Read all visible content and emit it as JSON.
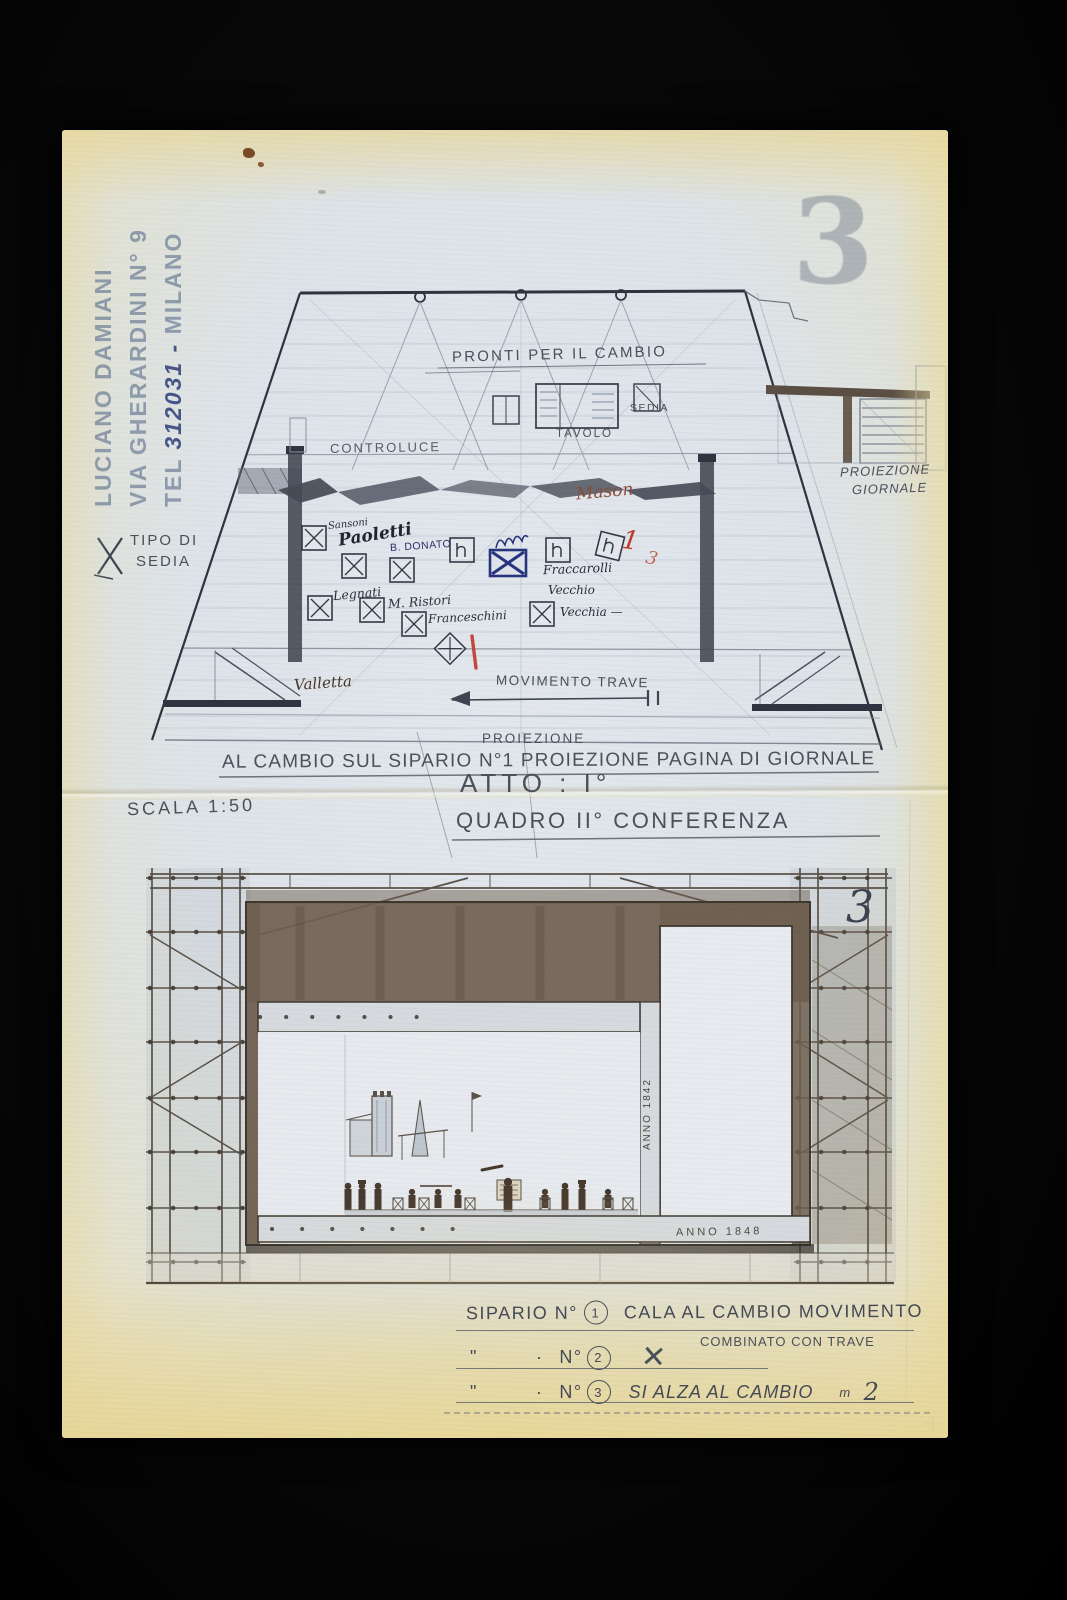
{
  "colors": {
    "red_ink": "#c0392b",
    "blue_ink": "#27357e",
    "sepia": "#6f6050",
    "stamp_blue": "#6c7a94",
    "paper_yellow": "#e9dfb6"
  },
  "stamp": {
    "line1": "LUCIANO DAMIANI",
    "line2": "VIA GHERARDINI N° 9",
    "tel_prefix": "TEL ",
    "tel_number": "312031 -",
    "tel_city": " MILANO"
  },
  "sheet": {
    "number_stamp": "3",
    "number_note": "3"
  },
  "plan": {
    "pronti": "PRONTI PER IL CAMBIO",
    "tavolo": "TAVOLO",
    "sedia": "SEDIA",
    "controluce": "CONTROLUCE",
    "tipo_di_sedia_line1": "TIPO DI",
    "tipo_di_sedia_line2": "SEDIA",
    "mason": "Mason",
    "valletta": "Valletta",
    "movimento_trave": "MOVIMENTO TRAVE",
    "proiezione": "PROIEZIONE",
    "proiezione_giornale_line1": "PROIEZIONE",
    "proiezione_giornale_line2": "GIORNALE",
    "names": {
      "sansoni": "Sansoni",
      "paoletti": "Paoletti",
      "b_donato": "B. DONATO",
      "legnati": "Legnati",
      "ristori": "M. Ristori",
      "franceschini": "Franceschini",
      "fraccarolli": "Fraccarolli",
      "vecchio": "Vecchio",
      "vecchia": "Vecchia —"
    },
    "red_marks": {
      "one": "1",
      "three": "3"
    }
  },
  "captions": {
    "cambio": "AL CAMBIO SUL SIPARIO N°1 PROIEZIONE PAGINA DI GIORNALE",
    "atto": "ATTO : I°",
    "scala": "SCALA 1:50",
    "quadro": "QUADRO II° CONFERENZA"
  },
  "elevation": {
    "anno_side": "ANNO 1842",
    "anno_beam": "ANNO 1848"
  },
  "legend": {
    "row1_label": "SIPARIO N°",
    "row1_num": "1",
    "row1_text": "CALA AL CAMBIO MOVIMENTO",
    "row1_sub": "COMBINATO CON TRAVE",
    "row2_ditto": "\"",
    "row2_dot": "·",
    "row2_label": "N°",
    "row2_num": "2",
    "row2_mark": "✕",
    "row3_ditto": "\"",
    "row3_dot": "·",
    "row3_label": "N°",
    "row3_num": "3",
    "row3_text": "SI ALZA AL CAMBIO",
    "row3_unit": "m",
    "row3_value": "2"
  }
}
